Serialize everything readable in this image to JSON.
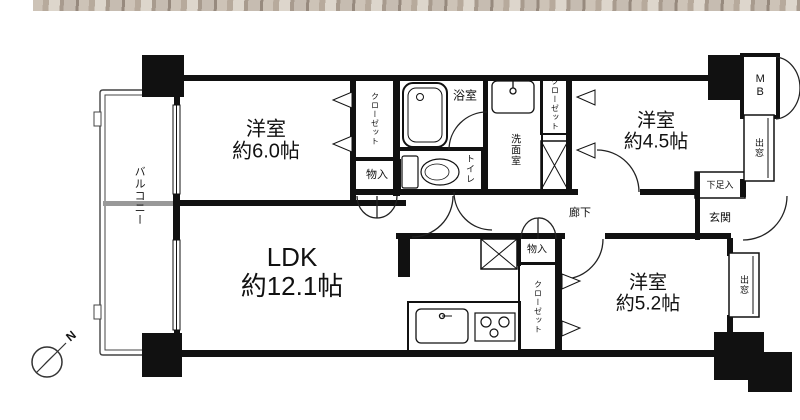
{
  "floorplan": {
    "compass": {
      "north": "N"
    },
    "rooms": {
      "bedroom_6": {
        "name": "洋室",
        "size": "約6.0帖"
      },
      "bedroom_4_5": {
        "name": "洋室",
        "size": "約4.5帖"
      },
      "bedroom_5_2": {
        "name": "洋室",
        "size": "約5.2帖"
      },
      "ldk": {
        "name": "LDK",
        "size": "約12.1帖"
      }
    },
    "labels": {
      "balcony": "バルコニー",
      "closet": "クローゼット",
      "storage": "物入",
      "bathroom": "浴室",
      "toilet": "トイレ",
      "washroom": "洗面室",
      "meter_box": "MB",
      "bay_window": "出窓",
      "shoe_cabinet": "下足入",
      "entrance": "玄関",
      "hallway": "廊下"
    },
    "colors": {
      "wall": "#111111",
      "line": "#222222",
      "background": "#ffffff",
      "wood_light": "#cdc3b7",
      "wood_dark": "#a89b8e",
      "partition_gray": "#999999"
    }
  }
}
